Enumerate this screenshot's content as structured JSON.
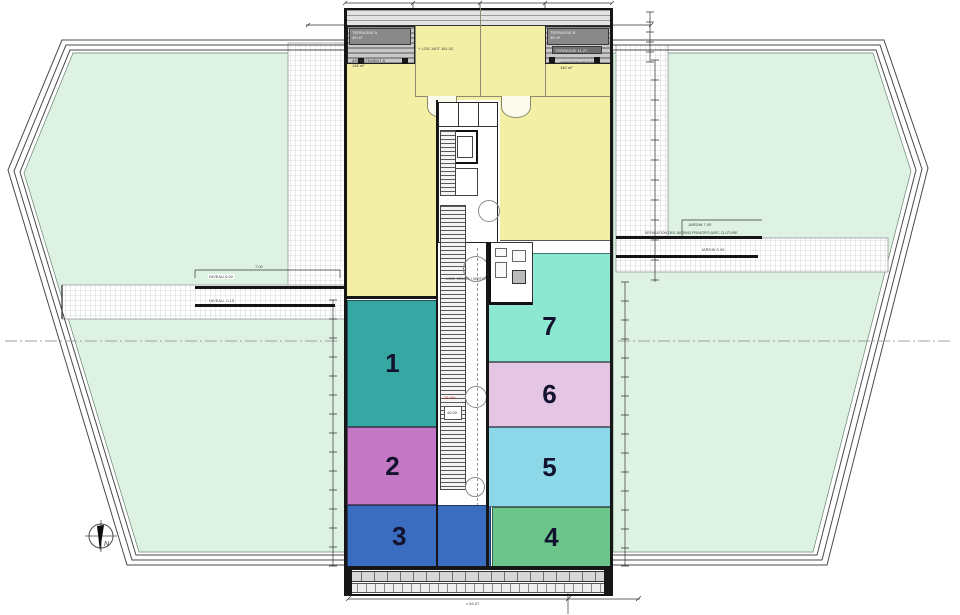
{
  "plan": {
    "zones": [
      {
        "number": "1",
        "color": "#36a7a3"
      },
      {
        "number": "2",
        "color": "#c377c5"
      },
      {
        "number": "3",
        "color": "#3a6cc0"
      },
      {
        "number": "4",
        "color": "#6cc68c"
      },
      {
        "number": "5",
        "color": "#8cd8e8"
      },
      {
        "number": "6",
        "color": "#e4c6e4"
      },
      {
        "number": "7",
        "color": "#8ce8d0"
      }
    ],
    "apartments": {
      "a_label": "APPARTEMENT A",
      "a_area": "146 m²",
      "b_label": "APPARTEMENT B",
      "b_area": "140 m²",
      "center_note": "+ LOG 1407 161.02"
    },
    "terraces": {
      "a_label": "TERRASSE A",
      "a_area": "40 m²",
      "b_label": "TERRASSE B",
      "b_area": "36 m²",
      "b_sub": "TERRASSE 11.27"
    },
    "core": {
      "load_note": "800 kg",
      "bike_note": "LOC. VELOS / MOTOS",
      "ramp_note": "15.4%",
      "level_note": "±0.00"
    },
    "dimensions": {
      "left_bracket": "7.00",
      "left_1": "NIVEAU 0.00",
      "left_2": "NIVEAU -0.15",
      "right_sep": "SEPARATION DES JARDINS PRIVATIFS AVEC CLOTURE",
      "right_1": "JARDIN 7.00",
      "right_2": "JARDIN 5.00",
      "bottom": "≈ 54.07"
    },
    "compass_label": "N",
    "colors": {
      "outdoor": "#def2e4",
      "apartment_yellow": "#f3f0a5"
    }
  }
}
